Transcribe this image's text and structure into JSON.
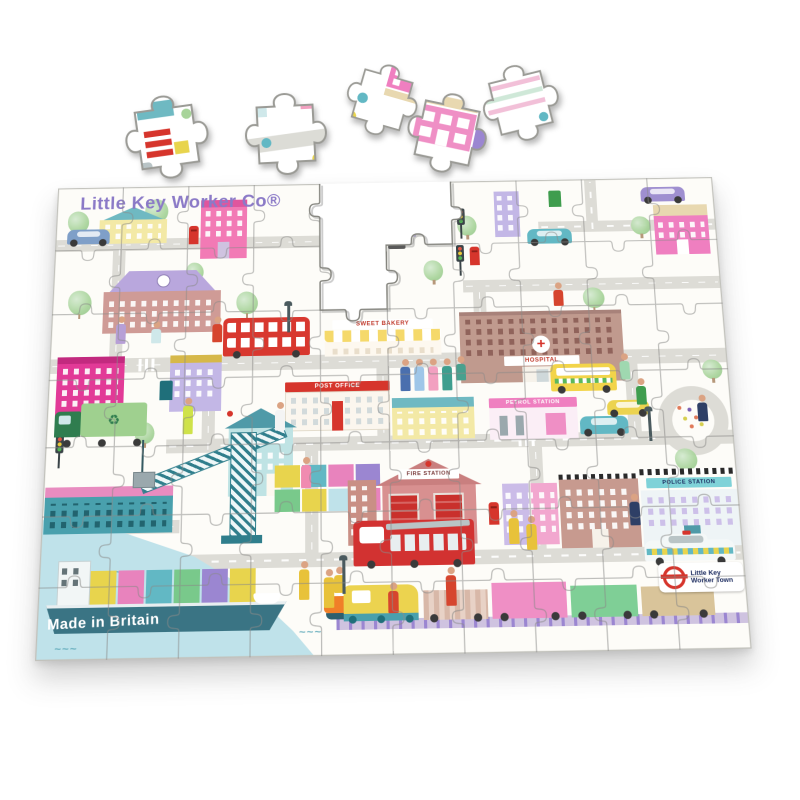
{
  "product": {
    "title": "Little Key Worker Co®",
    "madeIn": "Made in Britain",
    "roundel": {
      "line1": "Little Key",
      "line2": "Worker Town"
    }
  },
  "signs": {
    "postOffice": "POST OFFICE",
    "hospital": "HOSPITAL",
    "fireStation": "FIRE STATION",
    "policeStation": "POLICE STATION",
    "dentist": "DENTIST",
    "petrolStation": "PETROL STATION",
    "bakery": "SWEET BAKERY"
  },
  "puzzle": {
    "rows": 7,
    "cols": 10,
    "loosePieceCount": 5,
    "missingPieces": 3
  },
  "colors": {
    "titlePurple": "#8b7ac7",
    "postboxRed": "#d6352c",
    "waterBlue": "#bfe2ea",
    "roadGray": "#dddcd6",
    "boardWhite": "#fdfcf8",
    "hospitalBrick": "#c09a8e",
    "fireStationRose": "#d89090",
    "policeAqua": "#7fd2d8",
    "dentistTeal": "#bfe3e4"
  }
}
